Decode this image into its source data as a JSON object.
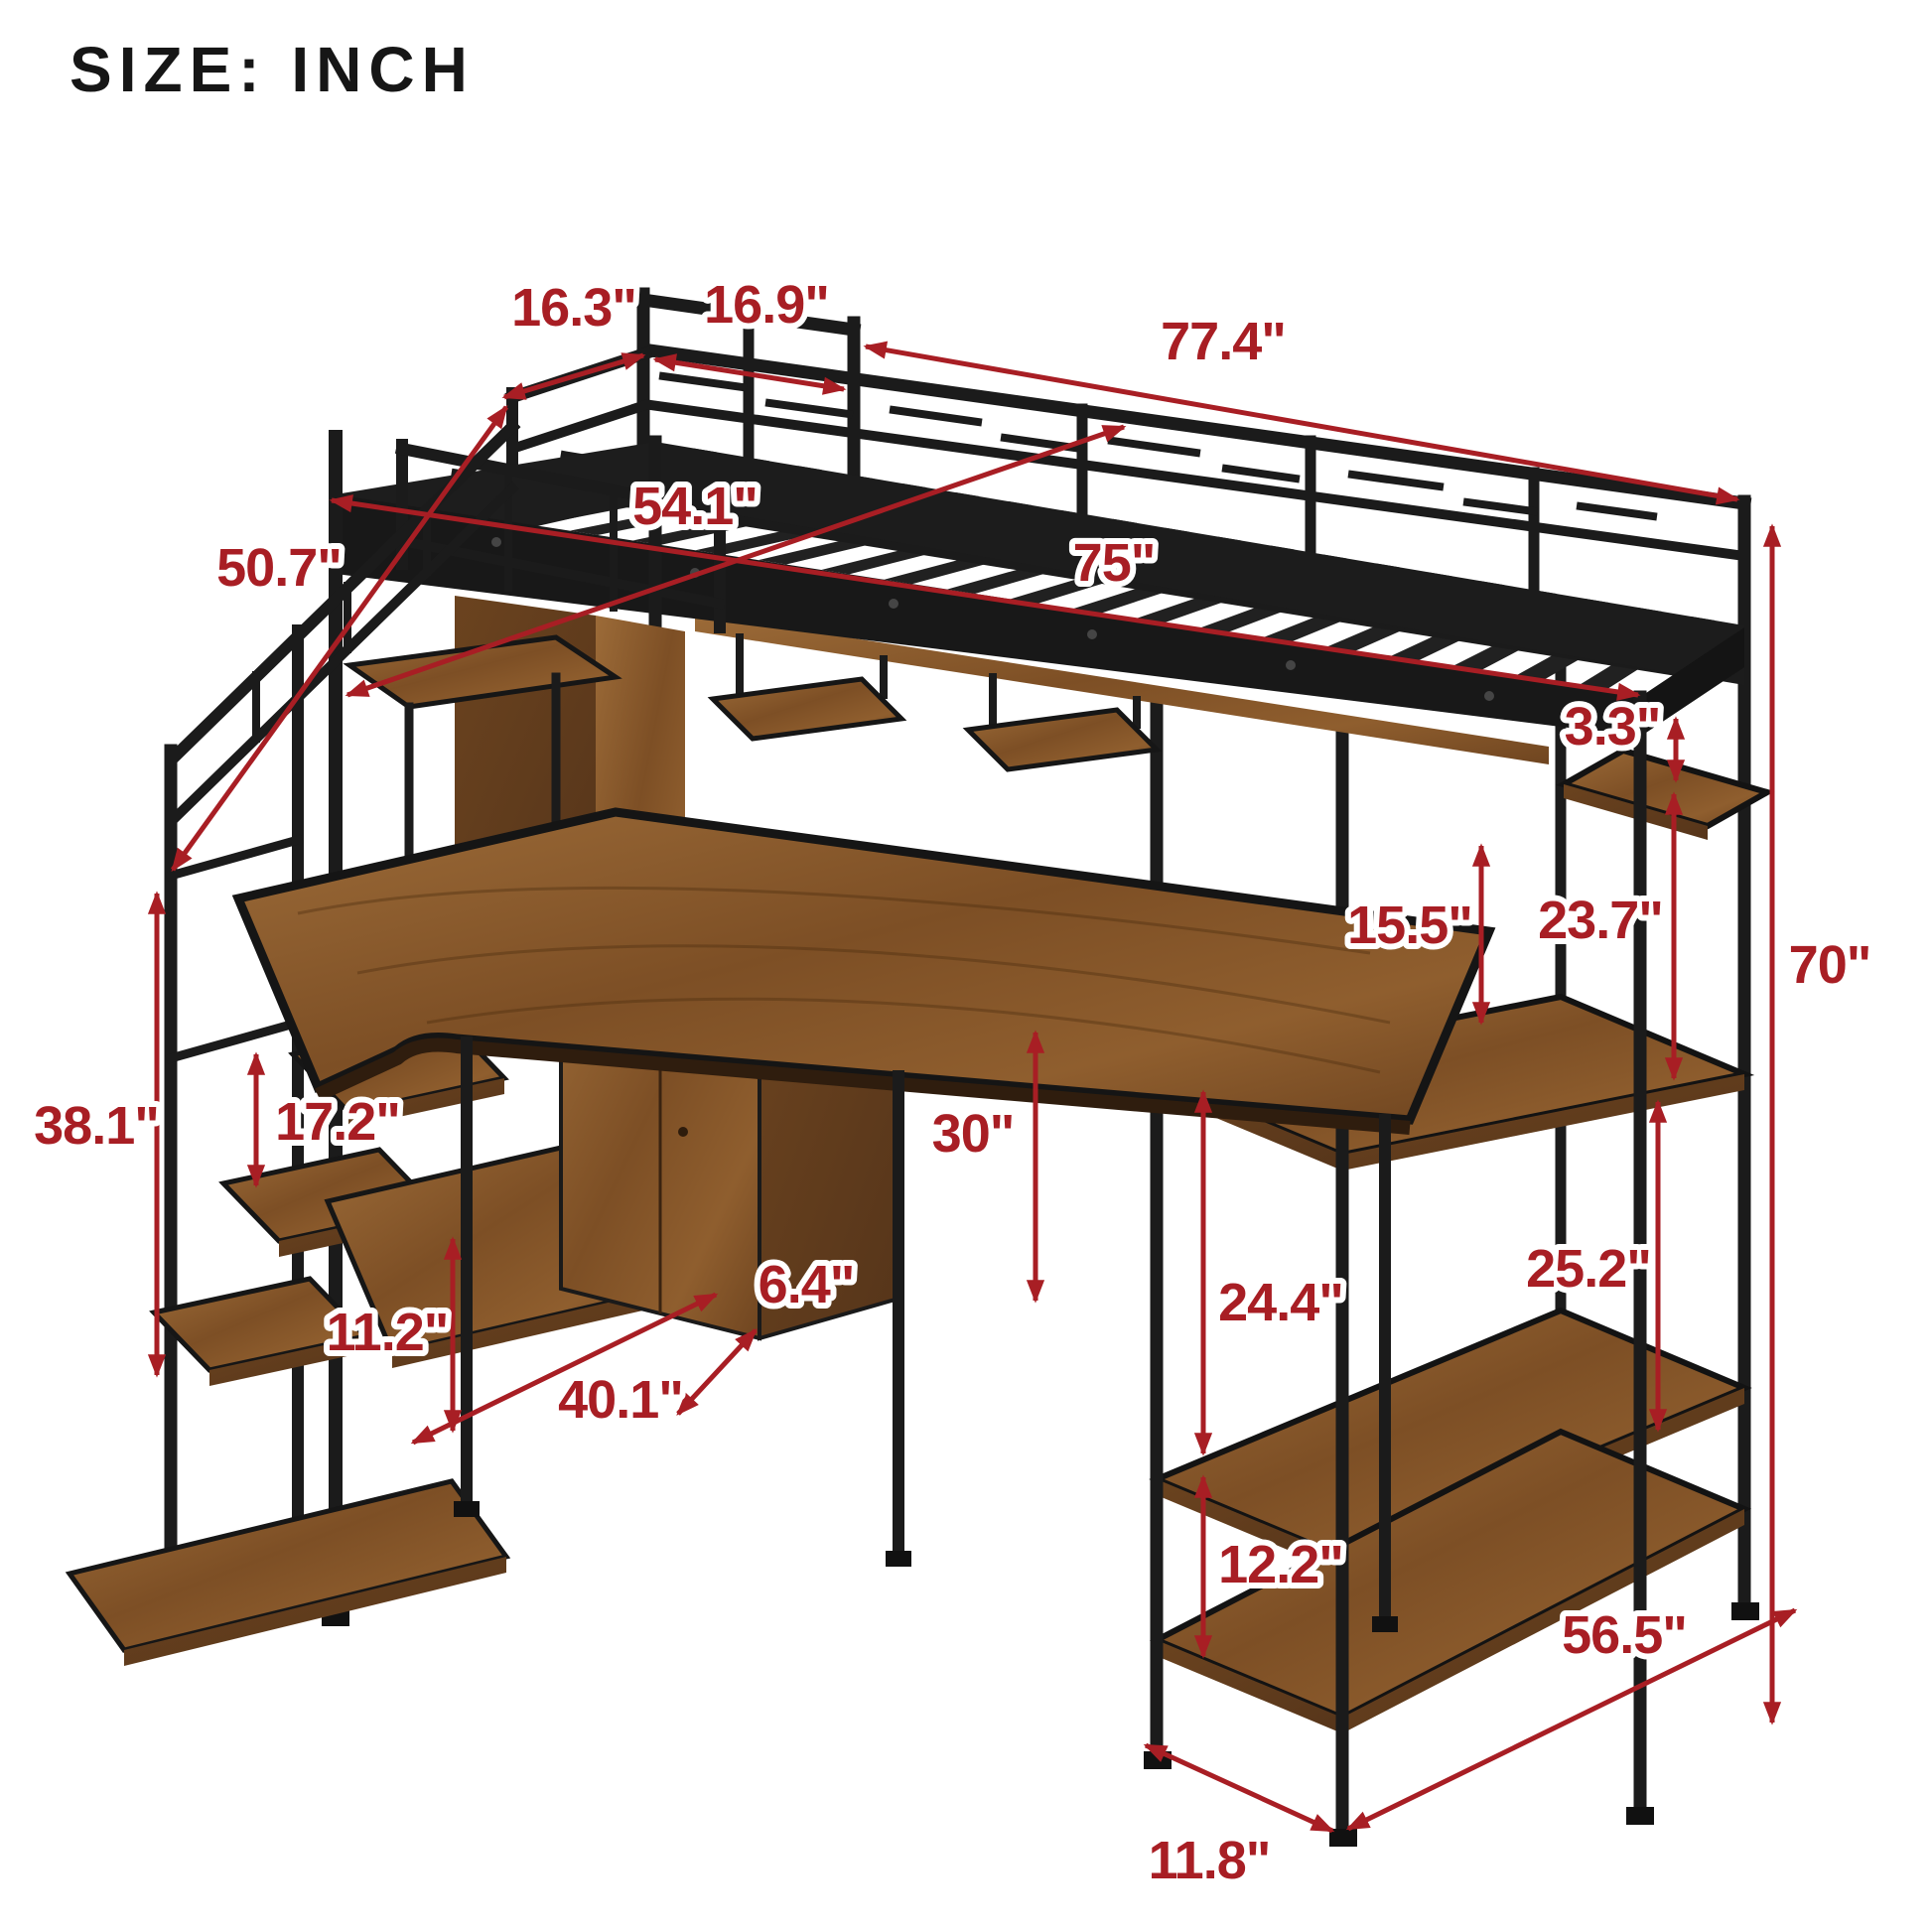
{
  "title": "SIZE: INCH",
  "colors": {
    "label_red": "#A81E24",
    "frame_black": "#1B1B1B",
    "wood_brown": "#8A5A2E",
    "background": "#FFFFFF"
  },
  "dims": [
    {
      "name": "stair-landing-depth",
      "text": "16.3\""
    },
    {
      "name": "head-rail-section",
      "text": "16.9\""
    },
    {
      "name": "overall-length",
      "text": "77.4\""
    },
    {
      "name": "bed-width",
      "text": "54.1\""
    },
    {
      "name": "staircase-rail-length",
      "text": "50.7\""
    },
    {
      "name": "bed-length",
      "text": "75\""
    },
    {
      "name": "rail-to-shelf-gap",
      "text": "3.3\""
    },
    {
      "name": "bed-to-desk-clearance",
      "text": "15.5\""
    },
    {
      "name": "upper-shelf-gap",
      "text": "23.7\""
    },
    {
      "name": "overall-height",
      "text": "70\""
    },
    {
      "name": "stair-side-height",
      "text": "38.1\""
    },
    {
      "name": "step-shelf-gap",
      "text": "17.2\""
    },
    {
      "name": "desk-height",
      "text": "30\""
    },
    {
      "name": "lower-step-gap",
      "text": "11.2\""
    },
    {
      "name": "cabinet-depth",
      "text": "6.4\""
    },
    {
      "name": "desk-length",
      "text": "40.1\""
    },
    {
      "name": "middle-shelf-gap",
      "text": "24.4\""
    },
    {
      "name": "side-shelf-gap",
      "text": "25.2\""
    },
    {
      "name": "bottom-shelf-gap",
      "text": "12.2\""
    },
    {
      "name": "overall-depth",
      "text": "56.5\""
    },
    {
      "name": "shelf-depth",
      "text": "11.8\""
    }
  ]
}
